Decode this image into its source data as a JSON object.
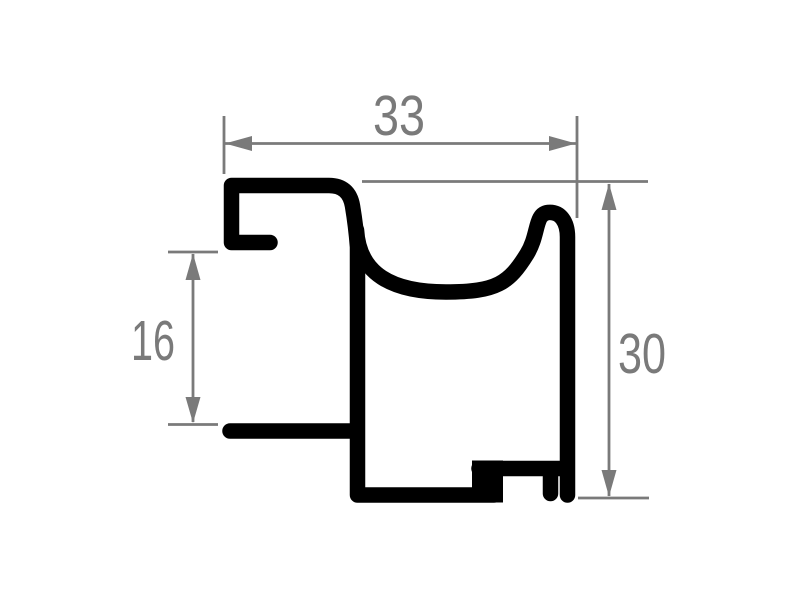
{
  "colors": {
    "background": "#ffffff",
    "profile": "#000000",
    "dimension": "#7a7a7a"
  },
  "dimensions": {
    "width": {
      "value": "33",
      "orientation": "horizontal",
      "position": "top"
    },
    "rebate_height": {
      "value": "16",
      "orientation": "vertical",
      "position": "left"
    },
    "overall_height": {
      "value": "30",
      "orientation": "vertical",
      "position": "right"
    }
  }
}
